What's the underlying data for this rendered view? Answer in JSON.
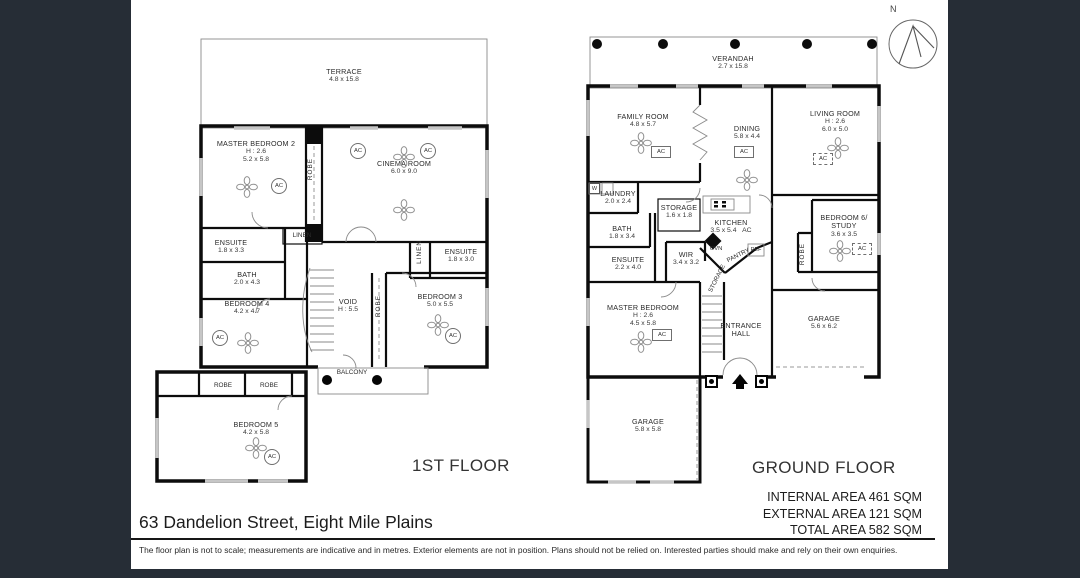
{
  "page": {
    "frame_color": "#262d36",
    "wall_color": "#0c0c0c",
    "background_color": "#ffffff"
  },
  "glyphs": {
    "ac": "AC",
    "robe": "ROBE",
    "linen": "LINEN",
    "washer": "W",
    "oven": "OVN",
    "fridge": "REF",
    "pantry": "PANTRY",
    "storage": "STORAGE",
    "north": "N"
  },
  "first_floor": {
    "title": "1ST FLOOR",
    "terrace": {
      "name": "TERRACE",
      "dims": "4.8 x 15.8"
    },
    "master_bedroom_2": {
      "name": "MASTER BEDROOM 2",
      "height": "H : 2.6",
      "dims": "5.2 x 5.8"
    },
    "cinema_room": {
      "name": "CINEMA ROOM",
      "dims": "6.0 x 9.0"
    },
    "ensuite_left": {
      "name": "ENSUITE",
      "dims": "1.8 x 3.3"
    },
    "bath": {
      "name": "BATH",
      "dims": "2.0 x 4.3"
    },
    "ensuite_right": {
      "name": "ENSUITE",
      "dims": "1.8 x 3.0"
    },
    "void": {
      "name": "VOID",
      "height": "H : 5.5"
    },
    "bedroom_3": {
      "name": "BEDROOM 3",
      "dims": "5.0 x 5.5"
    },
    "bedroom_4": {
      "name": "BEDROOM 4",
      "dims": "4.2 x 4.7"
    },
    "balcony": {
      "name": "BALCONY"
    },
    "bedroom_5": {
      "name": "BEDROOM 5",
      "dims": "4.2 x 5.8"
    }
  },
  "ground_floor": {
    "title": "GROUND FLOOR",
    "verandah": {
      "name": "VERANDAH",
      "dims": "2.7 x 15.8"
    },
    "family_room": {
      "name": "FAMILY ROOM",
      "dims": "4.8 x 5.7"
    },
    "dining": {
      "name": "DINING",
      "dims": "5.8 x 4.4"
    },
    "living_room": {
      "name": "LIVING ROOM",
      "height": "H : 2.6",
      "dims": "6.0 x 5.0"
    },
    "laundry": {
      "name": "LAUNDRY",
      "dims": "2.0 x 2.4"
    },
    "storage": {
      "name": "STORAGE",
      "dims": "1.6 x 1.8"
    },
    "bath": {
      "name": "BATH",
      "dims": "1.8 x 3.4"
    },
    "kitchen": {
      "name": "KITCHEN",
      "dims": "3.5 x 5.4"
    },
    "ensuite": {
      "name": "ENSUITE",
      "dims": "2.2 x 4.0"
    },
    "wir": {
      "name": "WIR",
      "dims": "3.4 x 3.2"
    },
    "bedroom_6": {
      "line1": "BEDROOM 6/",
      "line2": "STUDY",
      "dims": "3.6 x 3.5"
    },
    "master_bedroom": {
      "name": "MASTER BEDROOM",
      "height": "H : 2.6",
      "dims": "4.5 x 5.8"
    },
    "entrance_hall": {
      "line1": "ENTRANCE",
      "line2": "HALL"
    },
    "garage_rear": {
      "name": "GARAGE",
      "dims": "5.6 x 6.2"
    },
    "garage_front": {
      "name": "GARAGE",
      "dims": "5.8 x 5.8"
    }
  },
  "areas": {
    "internal": "INTERNAL AREA 461 SQM",
    "external": "EXTERNAL AREA 121 SQM",
    "total": "TOTAL AREA 582 SQM"
  },
  "footer": {
    "address": "63 Dandelion Street, Eight Mile Plains",
    "disclaimer": "The floor plan is not to scale; measurements are indicative and in metres. Exterior elements are not in position. Plans should not be relied on. Interested parties should make and rely on their own enquiries."
  }
}
